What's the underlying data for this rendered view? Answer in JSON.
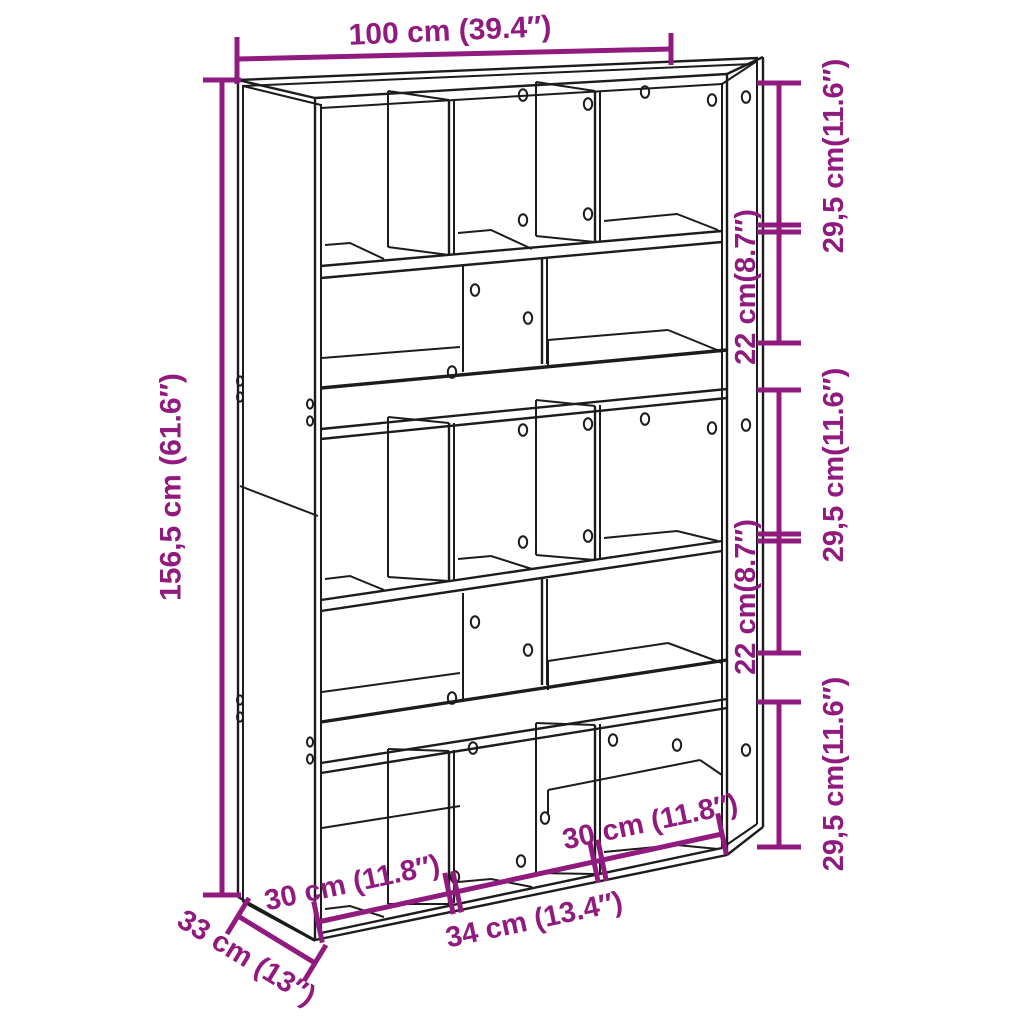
{
  "diagram": {
    "type": "furniture-dimension-diagram",
    "subject": "room-divider-bookcase",
    "colors": {
      "dimension": "#911A7F",
      "outline": "#1c1c1c",
      "background": "#ffffff"
    },
    "dimensions": {
      "width": "100 cm (39.4″)",
      "height": "156,5 cm (61.6″)",
      "depth": "33 cm (13″)",
      "right": [
        "29,5 cm(11.6″)",
        "22 cm(8.7″)",
        "29,5 cm(11.6″)",
        "22 cm(8.7″)",
        "29,5 cm(11.6″)"
      ],
      "bottom": [
        "30 cm (11.8″)",
        "34 cm (13.4″)",
        "30 cm (11.8″)"
      ]
    }
  }
}
